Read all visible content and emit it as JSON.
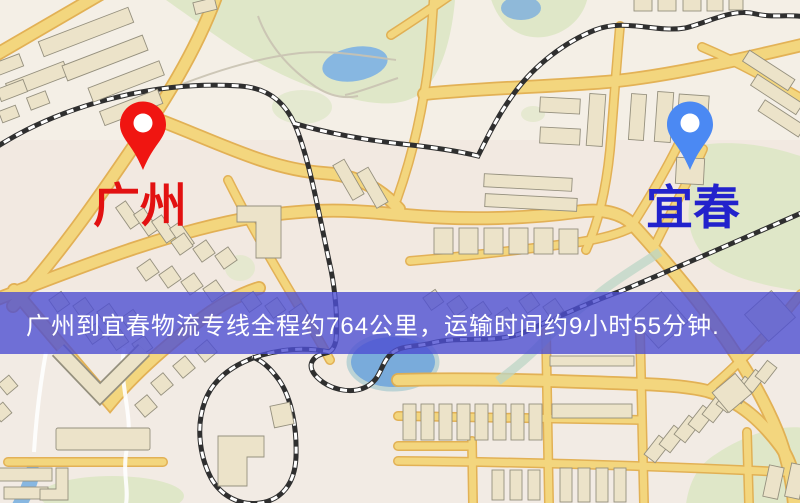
{
  "banner": {
    "text": "广州到宜春物流专线全程约764公里，运输时间约9小时55分钟.",
    "background_color": "#4d4fd2",
    "text_color": "#ffffff"
  },
  "markers": {
    "origin": {
      "label": "广州",
      "pin_color": "#f01511",
      "label_color": "#e21111"
    },
    "destination": {
      "label": "宜春",
      "pin_color": "#4b89f3",
      "label_color": "#2222cc"
    }
  },
  "map_colors": {
    "background": "#f4efe6",
    "road_fill": "#f3d67e",
    "road_casing": "#e2ae4e",
    "park_green": "#dfe7c8",
    "water_blue": "#82b2dd",
    "building_tan": "#ece3c9",
    "railway_dark": "#2f2f2f"
  }
}
